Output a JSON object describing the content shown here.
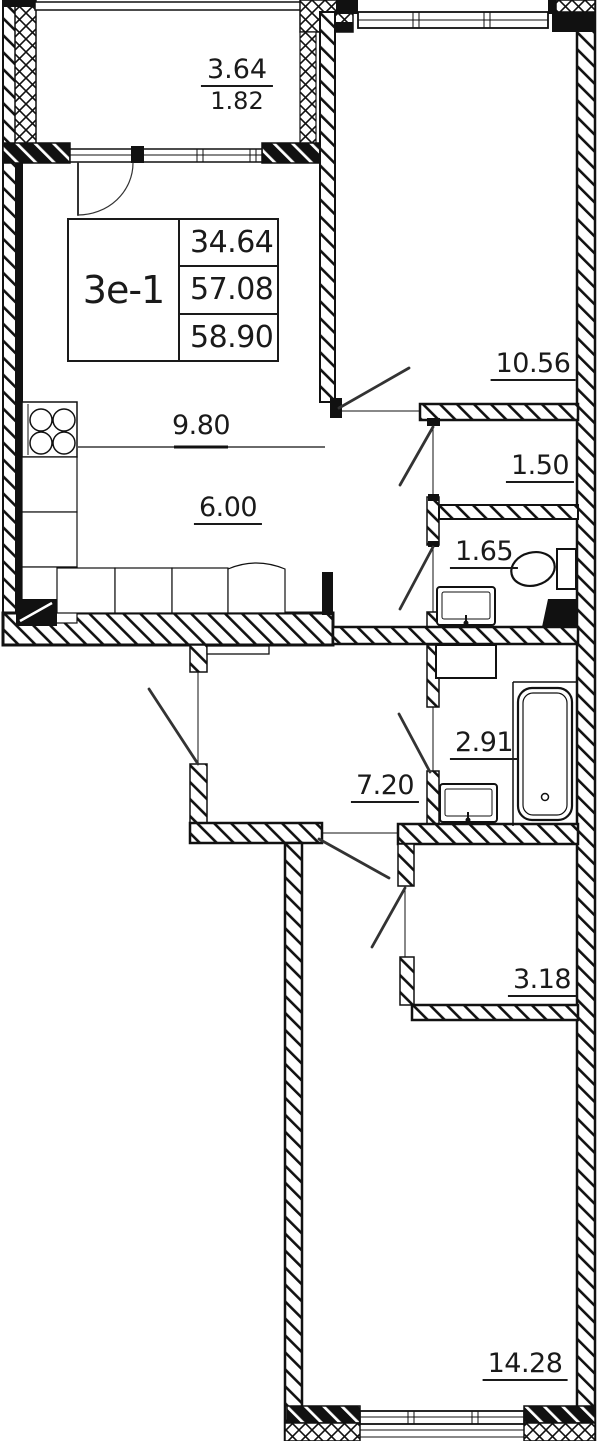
{
  "unit": {
    "name": "3e-1",
    "values": [
      "34.64",
      "57.08",
      "58.90"
    ]
  },
  "areas": {
    "balcony_top": "3.64",
    "balcony_bottom": "1.82",
    "bedroom_top": "10.56",
    "wardrobe": "1.50",
    "wc": "1.65",
    "kitchen_zone": "9.80",
    "living_zone": "6.00",
    "bathroom": "2.91",
    "hallway": "7.20",
    "storage": "3.18",
    "bedroom_bottom": "14.28"
  },
  "colors": {
    "ink": "#111111",
    "bg": "#ffffff"
  }
}
